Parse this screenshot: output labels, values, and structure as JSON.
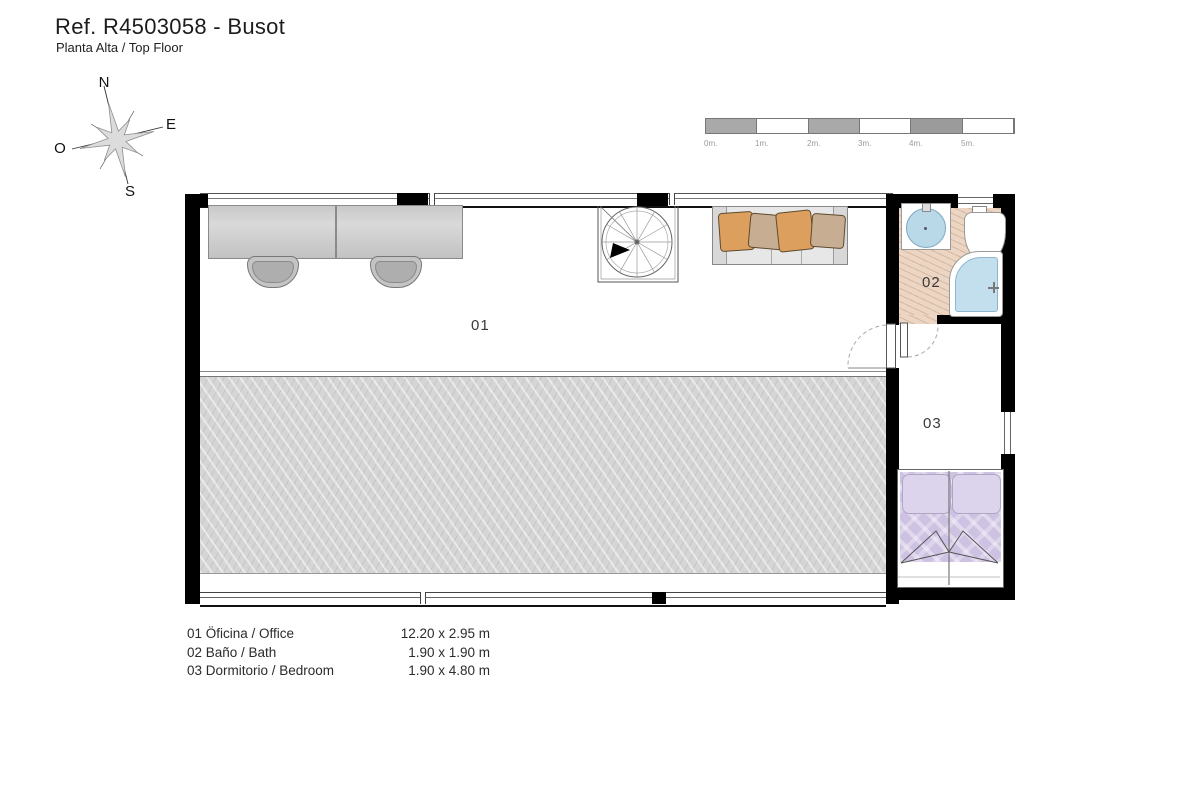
{
  "header": {
    "title": "Ref. R4503058 - Busot",
    "subtitle": "Planta Alta / Top Floor"
  },
  "compass": {
    "n": "N",
    "e": "E",
    "s": "S",
    "w": "O"
  },
  "scale_bar": {
    "labels": [
      "0m.",
      "1m.",
      "2m.",
      "3m.",
      "4m.",
      "5m."
    ]
  },
  "plan": {
    "room_labels": {
      "office": "01",
      "bath": "02",
      "bedroom": "03"
    }
  },
  "legend": {
    "rows": [
      {
        "name": "01 Öficina  / Office",
        "size": "12.20 x 2.95 m"
      },
      {
        "name": "02 Baño / Bath",
        "size": "1.90 x 1.90 m"
      },
      {
        "name": "03 Dormitorio / Bedroom",
        "size": "1.90 x 4.80 m"
      }
    ]
  },
  "colors": {
    "wall": "#000000",
    "terrace": "#d5d5d5",
    "bath_tile": "#ecd6c3",
    "water_blue": "#c3dfee",
    "blanket_lavender": "#cec2e3",
    "pillow_orange": "#dd9f5e",
    "pillow_tan": "#c7ae93"
  }
}
